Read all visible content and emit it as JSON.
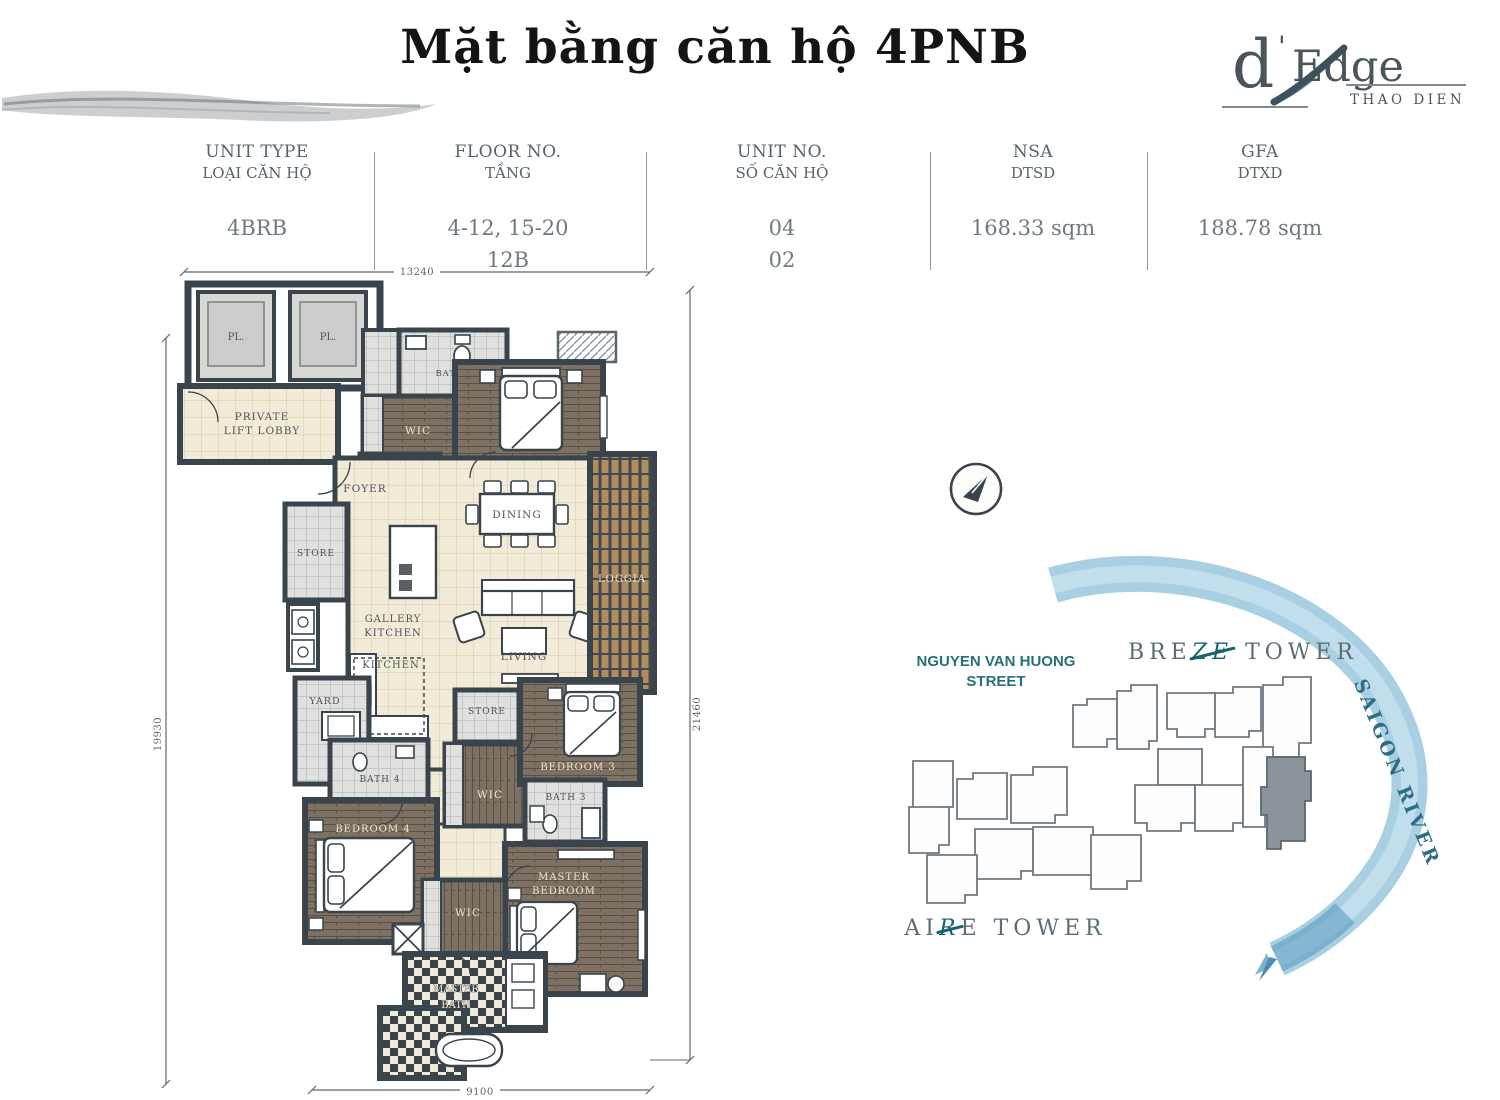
{
  "page_title": "Mặt bằng căn hộ 4PNB",
  "logo": {
    "d": "d",
    "apostrophe": "'",
    "edge": "Edge",
    "subtitle": "THAO DIEN"
  },
  "header": {
    "columns": [
      {
        "label1": "UNIT TYPE",
        "label2": "LOẠI CĂN HỘ",
        "value1": "4BRB",
        "value2": ""
      },
      {
        "label1": "FLOOR NO.",
        "label2": "TẦNG",
        "value1": "4-12, 15-20",
        "value2": "12B"
      },
      {
        "label1": "UNIT NO.",
        "label2": "SỐ CĂN HỘ",
        "value1": "04",
        "value2": "02"
      },
      {
        "label1": "NSA",
        "label2": "DTSD",
        "value1": "168.33 sqm",
        "value2": ""
      },
      {
        "label1": "GFA",
        "label2": "DTXD",
        "value1": "188.78 sqm",
        "value2": ""
      }
    ]
  },
  "floorplan": {
    "dim_top": "13240",
    "dim_left": "19930",
    "dim_right": "21460",
    "dim_bottom": "9100",
    "rooms": {
      "lift": "PL.",
      "lobby_line1": "PRIVATE",
      "lobby_line2": "LIFT LOBBY",
      "bath2": "BATH 2",
      "wic_top": "WIC",
      "bedroom2": "BEDROOM 2",
      "shoe": "SHOE",
      "foyer": "FOYER",
      "dining": "DINING",
      "store_left": "STORE",
      "gallery_line1": "GALLERY",
      "gallery_line2": "KITCHEN",
      "kitchen": "KITCHEN",
      "living": "LIVING",
      "loggia": "LOGGIA",
      "yard": "YARD",
      "bath4": "BATH 4",
      "bedroom4": "BEDROOM 4",
      "store_mid": "STORE",
      "wic_mid": "WIC",
      "bedroom3": "BEDROOM 3",
      "bath3": "BATH 3",
      "master_line1": "MASTER",
      "master_line2": "BEDROOM",
      "wic_bottom": "WIC",
      "mbath_line1": "MASTER",
      "mbath_line2": "BATH"
    }
  },
  "site": {
    "street_line1": "NGUYEN VAN HUONG",
    "street_line2": "STREET",
    "breeze_pre": "BRE",
    "breeze_accent": "ZE",
    "breeze_post": "TOWER",
    "aire_pre": "AI",
    "aire_accent": "R",
    "aire_post": "E",
    "aire_post2": "TOWER",
    "river": "SAIGON RIVER"
  },
  "colors": {
    "wall": "#39444d",
    "cream_floor": "#f2ebd8",
    "wood_floor": "#7e7163",
    "loggia_wood": "#b18d5e",
    "tile": "#dddedb",
    "accent_teal": "#16626e",
    "river_blue": "#a9cfe2",
    "highlight_unit": "#8b949b",
    "text_gray": "#55636c"
  }
}
